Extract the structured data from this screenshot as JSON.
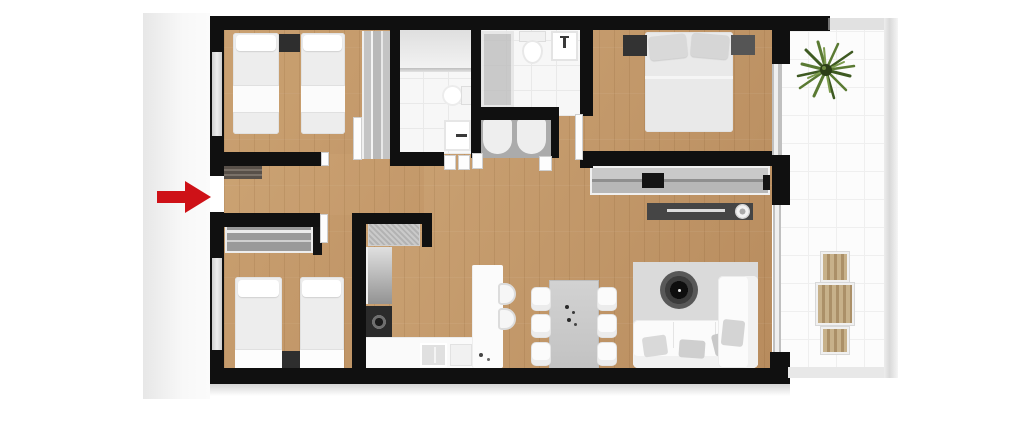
{
  "floor_plan": {
    "entrance": {
      "indicator": "red-arrow",
      "glyph": "→",
      "side": "left-wall"
    },
    "rooms": [
      {
        "id": "bedroom-1",
        "position": "top-left",
        "furniture": [
          "twin bed",
          "twin bed",
          "nightstand",
          "sliding-door wardrobe"
        ]
      },
      {
        "id": "bathroom-1",
        "position": "top-center-left",
        "furniture": [
          "shower with glass screen",
          "toilet",
          "washbasin"
        ]
      },
      {
        "id": "bathroom-2",
        "position": "top-center",
        "furniture": [
          "shower screen",
          "toilet",
          "washbasin"
        ]
      },
      {
        "id": "laundry-closet",
        "position": "center",
        "furniture": [
          "twin basin units"
        ]
      },
      {
        "id": "master-bedroom",
        "position": "top-right",
        "furniture": [
          "double bed",
          "nightstand",
          "nightstand",
          "long sliding wardrobe",
          "TV sideboard"
        ]
      },
      {
        "id": "living-dining",
        "position": "bottom-right",
        "furniture": [
          "L-shaped sofa",
          "area rug",
          "round coffee table",
          "dining table",
          "6 dining chairs"
        ]
      },
      {
        "id": "kitchen",
        "position": "bottom-center",
        "furniture": [
          "tall cabinet",
          "fridge",
          "oven",
          "sink counter",
          "breakfast bar",
          "2 bar stools"
        ]
      },
      {
        "id": "bedroom-2",
        "position": "bottom-left",
        "furniture": [
          "twin bed",
          "twin bed",
          "nightstand",
          "shelved wardrobe"
        ]
      },
      {
        "id": "hallway",
        "position": "center-left",
        "furniture": [
          "entrance mat"
        ]
      },
      {
        "id": "terrace",
        "position": "right",
        "furniture": [
          "potted plant",
          "outdoor table",
          "2 outdoor chairs"
        ]
      }
    ],
    "counts": {
      "bedrooms": 3,
      "bathrooms": 2,
      "beds": 5,
      "dining_chairs": 6,
      "bar_stools": 2,
      "outdoor_chairs": 2
    }
  },
  "colors": {
    "wall": "#101010",
    "wood_a": "#d2ab7c",
    "wood_b": "#b88c5e",
    "wood_line": "rgba(90,50,10,0.10)",
    "tile": "#f7f7f7",
    "tile_line": "#e9e9e9",
    "terrace_tile": "#fcfcfc",
    "terrace_line": "#efefef",
    "exterior_a": "#e7e7e7",
    "exterior_b": "#f8f8f8",
    "arrow_red": "#ce1117",
    "rug": "#dadada",
    "furniture_white": "#fbfbfb",
    "furniture_grey": "#c3c3c3",
    "furniture_dark": "#454545",
    "wardrobe_grey": "#9a9a9a",
    "laundry_grey": "#ababab",
    "glass_grey": "#c9c9c9",
    "plant_green_dark": "#3e5a22",
    "plant_green": "#5a7a33",
    "plant_green_light": "#7d9c4e",
    "outdoor_wood_a": "#c7b18a",
    "outdoor_wood_b": "#ab9068",
    "shadow": "rgba(0,0,0,0.16)"
  }
}
